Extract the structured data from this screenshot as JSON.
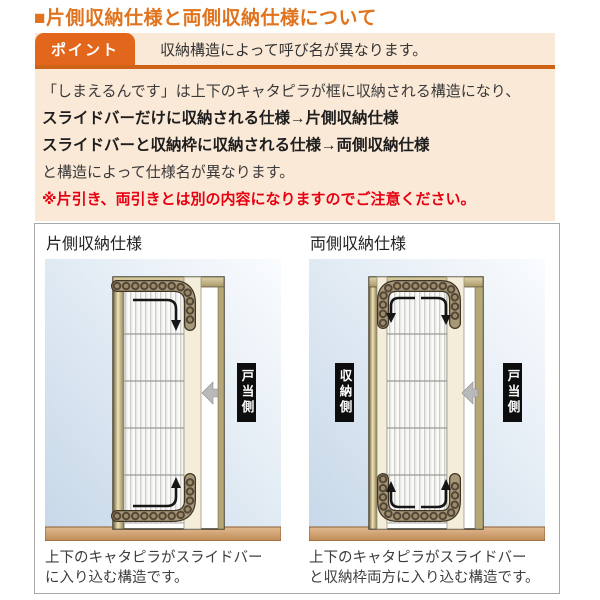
{
  "page": {
    "title": "■片側収納仕様と両側収納仕様について"
  },
  "point": {
    "tab_label": "ポイント",
    "message": "収納構造によって呼び名が異なります。"
  },
  "body": {
    "line1": "「しまえるんです」は上下のキャタピラが框に収納される構造になり、",
    "line2": "スライドバーだけに収納される仕様→片側収納仕様",
    "line3": "スライドバーと収納枠に収納される仕様→両側収納仕様",
    "line4": "と構造によって仕様名が異なります。",
    "warning": "※片引き、両引きとは別の内容になりますのでご注意ください。"
  },
  "diagrams": {
    "left": {
      "label": "片側収納仕様",
      "side_label_right": "戸当側",
      "caption_line1": "上下のキャタピラがスライドバー",
      "caption_line2": "に入り込む構造です。"
    },
    "right": {
      "label": "両側収納仕様",
      "side_label_left": "収納側",
      "side_label_right": "戸当側",
      "caption_line1": "上下のキャタピラがスライドバー",
      "caption_line2": "と収納枠両方に入り込む構造です。"
    }
  },
  "colors": {
    "accent_orange": "#e0731d",
    "tab_orange": "#e2661c",
    "rule_orange": "#ce6318",
    "peach_bg": "#fbe9d7",
    "warning_red": "#e60012",
    "frame_tan": "#b3a26c",
    "floor_tan": "#c89661",
    "diagram_blue": "#c6d7e8",
    "chain_brown": "#554738",
    "label_black": "#0d0d0d"
  }
}
